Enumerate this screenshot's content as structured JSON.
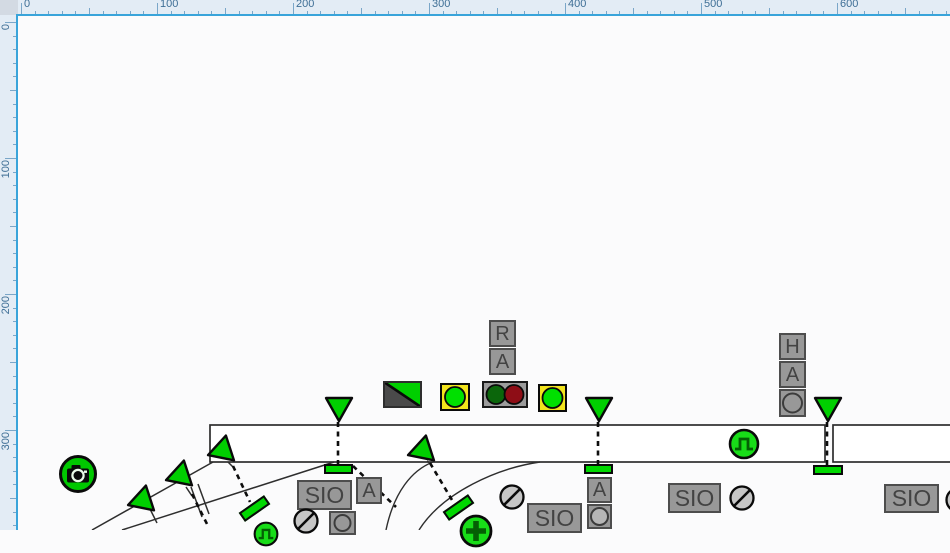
{
  "app": {
    "description": "railway interlocking track layout editor canvas"
  },
  "colors": {
    "signal_green": "#00d200",
    "dark_glyph_green": "#045f04",
    "box_gray": "#989898",
    "box_border": "#4d4d4d",
    "box_text": "#434343",
    "lamp_yellow": "#f2e41c",
    "aspect_dark_green": "#0b660b",
    "aspect_dark_red": "#8e0d16",
    "track_stroke": "#2e2e2e",
    "canvas_bg": "#fbfbfc",
    "ruler_bg": "#e3ecf5",
    "ruler_accent": "#39a4da",
    "ruler_text": "#3f6f96",
    "ruler_tick": "#7aa6c8",
    "disc_gray": "#c6c6c6",
    "split_dark": "#4a4a4a"
  },
  "rulers": {
    "top": {
      "labels": [
        "0",
        "100",
        "200",
        "300",
        "400",
        "500",
        "600"
      ],
      "origin_px": 21,
      "major_step_px": 136,
      "minor_step_px": 13.6
    },
    "left": {
      "labels": [
        "0",
        "100",
        "200",
        "300"
      ],
      "origin_px": 22,
      "major_step_px": 136,
      "minor_step_px": 13.6
    }
  },
  "tracks": {
    "bands": [
      {
        "x": 210,
        "y": 425,
        "w": 615,
        "h": 37
      },
      {
        "x": 833,
        "y": 425,
        "w": 120,
        "h": 37
      }
    ],
    "solid_lines": [
      "M213,462 L92,530",
      "M334,462 L122,530",
      "M191,487 L202,517",
      "M198,484 L209,514",
      "M150,509 L157,523",
      "M186,487 L192,496",
      "M228,462 L233,467",
      "M427,461 L431,464"
    ],
    "arcs": [
      "M433,462 C412,470 394,492 386,530",
      "M540,462 C498,468 443,492 419,530"
    ],
    "dashed_lines": [
      "M338,422 L338,464",
      "M598,422 L598,464",
      "M827,422 L827,466",
      "M233,466 L250,502",
      "M430,463 L452,500",
      "M192,494 L208,526",
      "M353,466 L396,507"
    ]
  },
  "symbols": [
    {
      "type": "camera",
      "name": "camera-icon",
      "cx": 78,
      "cy": 474,
      "r": 20
    },
    {
      "type": "triangle",
      "name": "signal-triangle",
      "x": 324,
      "y": 396,
      "rot": 0
    },
    {
      "type": "triangle",
      "name": "signal-triangle",
      "x": 584,
      "y": 396,
      "rot": 0
    },
    {
      "type": "triangle",
      "name": "signal-triangle",
      "x": 813,
      "y": 396,
      "rot": 0
    },
    {
      "type": "triangle",
      "name": "signal-triangle",
      "x": 204,
      "y": 438,
      "rot": 72
    },
    {
      "type": "triangle",
      "name": "signal-triangle",
      "x": 404,
      "y": 438,
      "rot": 72
    },
    {
      "type": "triangle",
      "name": "signal-triangle",
      "x": 162,
      "y": 463,
      "rot": 72
    },
    {
      "type": "triangle",
      "name": "signal-triangle",
      "x": 124,
      "y": 488,
      "rot": 72
    },
    {
      "type": "bar",
      "name": "route-bar",
      "x": 324,
      "y": 464,
      "w": 29,
      "h": 10,
      "rot": 0
    },
    {
      "type": "bar",
      "name": "route-bar",
      "x": 584,
      "y": 464,
      "w": 29,
      "h": 10,
      "rot": 0
    },
    {
      "type": "bar",
      "name": "route-bar",
      "x": 813,
      "y": 465,
      "w": 30,
      "h": 10,
      "rot": 0
    },
    {
      "type": "bar",
      "name": "route-bar",
      "x": 239,
      "y": 503,
      "w": 31,
      "h": 11,
      "rot": -35
    },
    {
      "type": "bar",
      "name": "route-bar",
      "x": 443,
      "y": 502,
      "w": 31,
      "h": 11,
      "rot": -35
    },
    {
      "type": "letterbox",
      "label": "R",
      "x": 489,
      "y": 320,
      "w": 27,
      "h": 27
    },
    {
      "type": "letterbox",
      "label": "A",
      "x": 489,
      "y": 348,
      "w": 27,
      "h": 27
    },
    {
      "type": "letterbox",
      "label": "H",
      "x": 779,
      "y": 333,
      "w": 27,
      "h": 27
    },
    {
      "type": "letterbox",
      "label": "A",
      "x": 779,
      "y": 361,
      "w": 27,
      "h": 27
    },
    {
      "type": "circlebox",
      "x": 779,
      "y": 389,
      "w": 27,
      "h": 28,
      "fill": "box"
    },
    {
      "type": "letterbox",
      "label": "A",
      "x": 356,
      "y": 477,
      "w": 26,
      "h": 27
    },
    {
      "type": "letterbox",
      "label": "A",
      "x": 587,
      "y": 477,
      "w": 25,
      "h": 26
    },
    {
      "type": "circlebox",
      "x": 587,
      "y": 504,
      "w": 25,
      "h": 25,
      "fill": "light"
    },
    {
      "type": "circlebox",
      "x": 329,
      "y": 511,
      "w": 27,
      "h": 24,
      "fill": "box"
    },
    {
      "type": "siobox",
      "label": "SIO",
      "x": 297,
      "y": 480,
      "w": 55,
      "h": 30
    },
    {
      "type": "siobox",
      "label": "SIO",
      "x": 527,
      "y": 503,
      "w": 55,
      "h": 30
    },
    {
      "type": "siobox",
      "label": "SIO",
      "x": 668,
      "y": 483,
      "w": 53,
      "h": 30
    },
    {
      "type": "siobox",
      "label": "SIO",
      "x": 884,
      "y": 484,
      "w": 55,
      "h": 29
    },
    {
      "type": "disc",
      "name": "shunt-disc-icon",
      "cx": 306,
      "cy": 521,
      "r": 13
    },
    {
      "type": "disc",
      "name": "shunt-disc-icon",
      "cx": 512,
      "cy": 497,
      "r": 13
    },
    {
      "type": "disc",
      "name": "shunt-disc-icon",
      "cx": 742,
      "cy": 498,
      "r": 13
    },
    {
      "type": "disc",
      "name": "shunt-disc-icon",
      "cx": 958,
      "cy": 500,
      "r": 13
    },
    {
      "type": "lamp",
      "name": "lamp-indicator",
      "x": 440,
      "y": 383,
      "w": 30,
      "h": 28
    },
    {
      "type": "lamp",
      "name": "lamp-indicator",
      "x": 538,
      "y": 384,
      "w": 29,
      "h": 28
    },
    {
      "type": "trafficlight",
      "name": "signal-aspect-pair",
      "x": 482,
      "y": 381,
      "w": 46,
      "h": 27
    },
    {
      "type": "split",
      "name": "split-state-indicator",
      "x": 383,
      "y": 381,
      "w": 39,
      "h": 27
    },
    {
      "type": "pulse",
      "name": "pulse-button",
      "cx": 744,
      "cy": 444,
      "r": 16
    },
    {
      "type": "pulse",
      "name": "pulse-button",
      "cx": 266,
      "cy": 534,
      "r": 13
    },
    {
      "type": "plus",
      "name": "plus-button",
      "cx": 476,
      "cy": 531,
      "r": 17
    }
  ]
}
